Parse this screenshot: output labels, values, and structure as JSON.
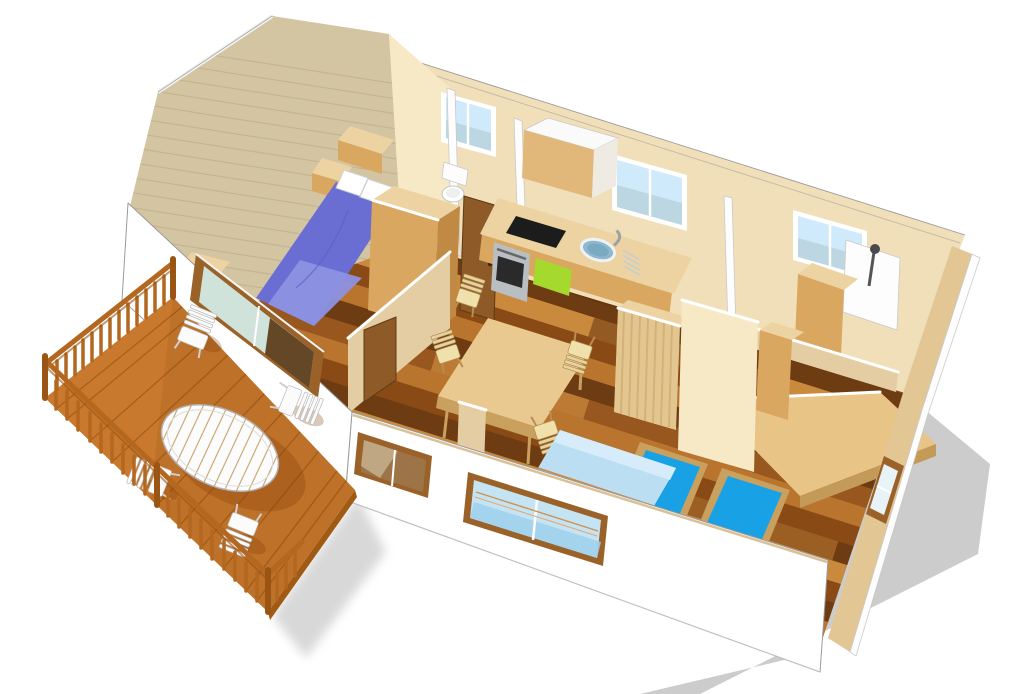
{
  "meta": {
    "description": "3D isometric cutaway rendering of a two-bedroom mobile home floor plan with wooden terrace",
    "view": "perspective-cutaway"
  },
  "colors": {
    "wall_white": "#ffffff",
    "wall_cream": "#f1dfb9",
    "wall_cream_lit": "#f7e9c6",
    "wall_cream_shade": "#e5cda3",
    "wall_wood": "#d3c4a2",
    "wood_grain": "#b9a884",
    "line": "#9a9a9a",
    "shadow": "#c9c9c9",
    "shadow_soft": "#d2d2d2",
    "floor_base": "#98571e",
    "plank_dark": "#6e3c12",
    "plank_mid": "#8a4a16",
    "plank_light": "#b9742e",
    "plank_lighter": "#ca8a3e",
    "deck": "#c8792d",
    "deck_seam": "#9a5512",
    "deck_edge": "#a05a14",
    "rail": "#b4671f",
    "rail_dark": "#9a5515",
    "furniture_wood": "#e9c98f",
    "furniture_wood_dark": "#caa05f",
    "cabinet_front": "#d9a75f",
    "cabinet_top": "#edd3a2",
    "cabinet_side": "#c08a45",
    "door_brown": "#8d5a28",
    "door_dark": "#5f3a14",
    "bed_purple": "#6a6ed2",
    "bed_purple_light": "#8d91e2",
    "bed_cyan": "#18a2e5",
    "bed_cyan_dark": "#0e7ec6",
    "bench_blue": "#bcdef2",
    "bench_blue_dark": "#9cc8e6",
    "bench_blue_light": "#d6ecfa",
    "glass": "#cfeafa",
    "glass_dim": "#b9d3dc",
    "glass_green": "#cfe3da",
    "frame_wood": "#9a6228",
    "kitchen_green": "#a6d92e",
    "platform_wood": "#e9c487",
    "steel": "#b9bec2",
    "appliance_black": "#1c1c1c",
    "white_fixture": "#fdfdfd"
  },
  "scene": {
    "terrace": {
      "items": [
        "wood-deck",
        "railing",
        "oval-slat-table",
        "garden-chair",
        "garden-chair",
        "garden-chair",
        "garden-chair"
      ]
    },
    "rooms": [
      {
        "name": "master-bedroom",
        "items": [
          "double-bed-purple",
          "pillows",
          "headboard-shelves",
          "side-shelf",
          "sliding-bay-window"
        ]
      },
      {
        "name": "wc",
        "items": [
          "toilet",
          "window",
          "door"
        ]
      },
      {
        "name": "hallway",
        "items": [
          "wardrobe",
          "door"
        ]
      },
      {
        "name": "kitchen",
        "items": [
          "counter",
          "sink",
          "cooktop",
          "oven",
          "green-cabinet",
          "overhead-cabinet",
          "window"
        ]
      },
      {
        "name": "living-dining",
        "items": [
          "dining-table",
          "dining-chair",
          "dining-chair",
          "dining-chair",
          "dining-chair",
          "bench-sofa",
          "front-windows"
        ]
      },
      {
        "name": "kids-bedroom",
        "items": [
          "twin-bed-blue",
          "twin-bed-blue",
          "bed-platform",
          "wardrobe",
          "side-window"
        ]
      },
      {
        "name": "shower-room",
        "items": [
          "shower-fixture",
          "shower-panel",
          "cabinet",
          "window"
        ]
      }
    ]
  }
}
